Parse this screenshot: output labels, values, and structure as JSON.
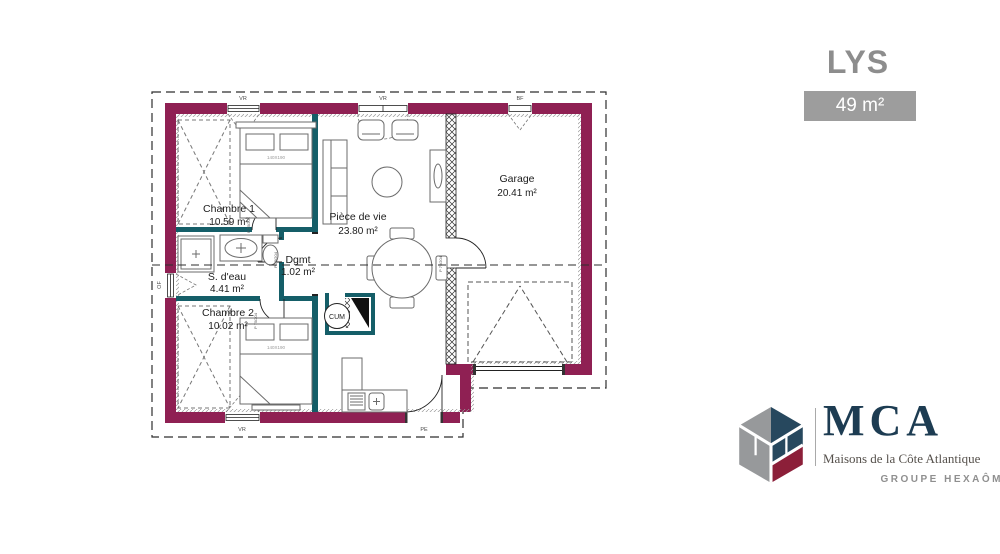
{
  "header": {
    "model_name": "LYS",
    "area_badge": "49 m²"
  },
  "floor_plan": {
    "rooms": [
      {
        "name": "Chambre 1",
        "area": "10.59 m²"
      },
      {
        "name": "S. d'eau",
        "area": "4.41 m²"
      },
      {
        "name": "Chambre 2",
        "area": "10.02 m²"
      },
      {
        "name": "Dgmt",
        "area": "1.02 m²"
      },
      {
        "name": "Pièce de vie",
        "area": "23.80 m²"
      },
      {
        "name": "Garage",
        "area": "20.41 m²"
      }
    ],
    "labels": {
      "water_heater": "CUM",
      "door": "P 75/204",
      "bed_size": "140X190",
      "window_roller": "VR",
      "garage_window": "BF",
      "entry_door": "PE",
      "bathroom_window": "OF"
    },
    "colors": {
      "exterior_wall": "#8F2053",
      "interior_wall": "#155E68"
    }
  },
  "logo": {
    "brand": "MCA",
    "tagline": "Maisons de la Côte Atlantique",
    "group": "GROUPE HEXAÔM"
  }
}
